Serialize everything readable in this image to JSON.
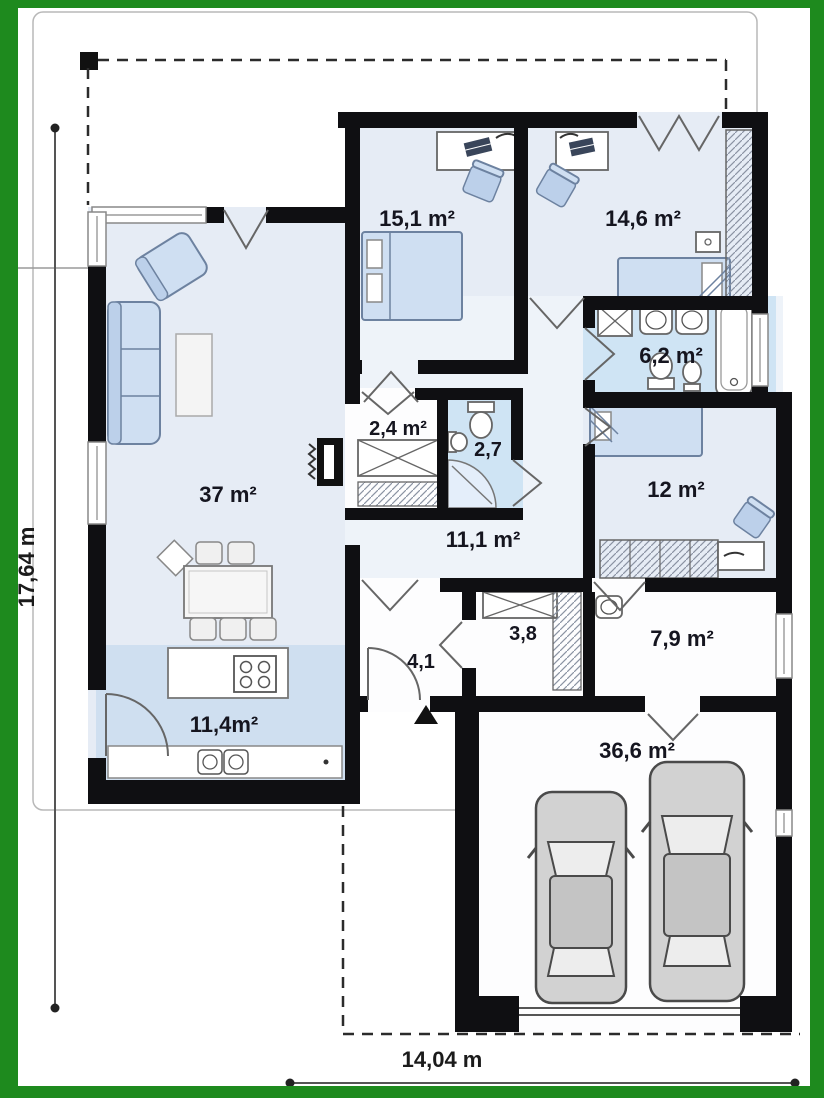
{
  "rooms": [
    {
      "id": "bedroom-1",
      "label": "15,1 m²"
    },
    {
      "id": "bedroom-2",
      "label": "14,6 m²"
    },
    {
      "id": "bathroom",
      "label": "6,2 m²"
    },
    {
      "id": "closet",
      "label": "2,4 m²"
    },
    {
      "id": "wc",
      "label": "2,7"
    },
    {
      "id": "living-room",
      "label": "37 m²"
    },
    {
      "id": "hallway",
      "label": "11,1 m²"
    },
    {
      "id": "bedroom-3",
      "label": "12 m²"
    },
    {
      "id": "hall-closet",
      "label": "3,8"
    },
    {
      "id": "entry",
      "label": "4,1"
    },
    {
      "id": "utility",
      "label": "7,9 m²"
    },
    {
      "id": "kitchen",
      "label": "11,4m²"
    },
    {
      "id": "garage",
      "label": "36,6 m²"
    }
  ],
  "dimensions": {
    "height": "17,64 m",
    "width": "14,04 m"
  },
  "colors": {
    "frame_green": "#1e8a1e",
    "wall_black": "#0f0f12",
    "room_light_blue": "#e6ecf5",
    "wet_room_blue": "#cfe4f4",
    "kitchen_blue": "#cfdff0",
    "hall_blue": "#eef3f9",
    "furniture_blue": "#cfdff2",
    "car_gray": "#d2d2d2",
    "label_ink": "#15151f"
  }
}
